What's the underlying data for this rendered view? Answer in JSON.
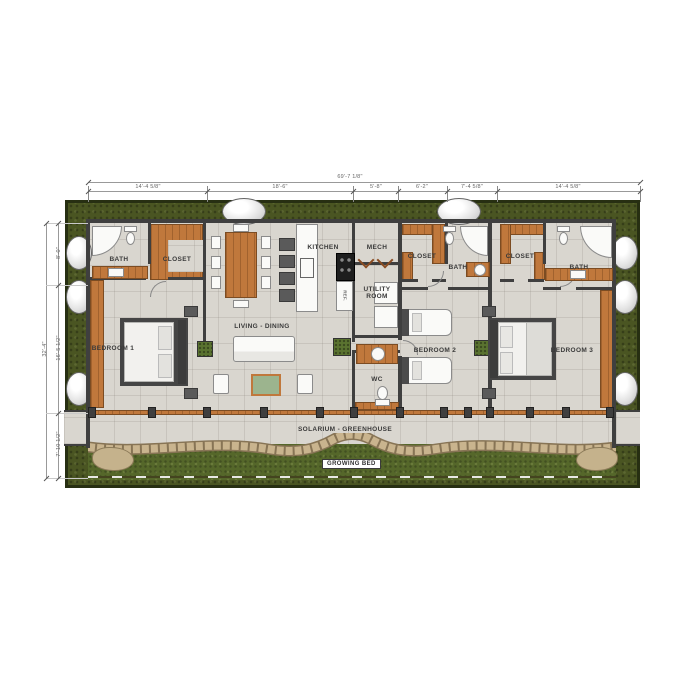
{
  "labels": {
    "bath_left": "BATH",
    "closet_left": "CLOSET",
    "bedroom1": "BEDROOM 1",
    "living_dining": "LIVING - DINING",
    "kitchen": "KITCHEN",
    "mech": "MECH",
    "utility_room": "UTILITY ROOM",
    "wc": "WC",
    "closet_mid": "CLOSET",
    "bath_mid": "BATH",
    "bedroom2": "BEDROOM 2",
    "closet_right": "CLOSET",
    "bath_right": "BATH",
    "bedroom3": "BEDROOM 3",
    "solarium": "SOLARIUM - GREENHOUSE",
    "growing_bed": "GROWING BED",
    "fridge": "REF."
  },
  "dimensions": {
    "top": {
      "overall": "69'-7 1/8\"",
      "segments": [
        "14'-4 5/8\"",
        "18'-6\"",
        "5'-8\"",
        "6'-2\"",
        "7'-4 5/8\"",
        "14'-4 5/8\""
      ]
    },
    "left": {
      "overall": "32'-4\"",
      "segments": [
        "8'-0\"",
        "16'-5 1/2\"",
        "7'-10 1/2\""
      ]
    }
  },
  "colors": {
    "berm": "#4a5522",
    "berm_outline": "#272f12",
    "grass": "#55672a",
    "floor": "#d9d6cf",
    "wall": "#3f3f3f",
    "wood": "#c0783c",
    "stone": "#c9b48e",
    "stone_edge": "#877455",
    "table_top": "#9cb48e",
    "fixture": "#fafaf8"
  }
}
